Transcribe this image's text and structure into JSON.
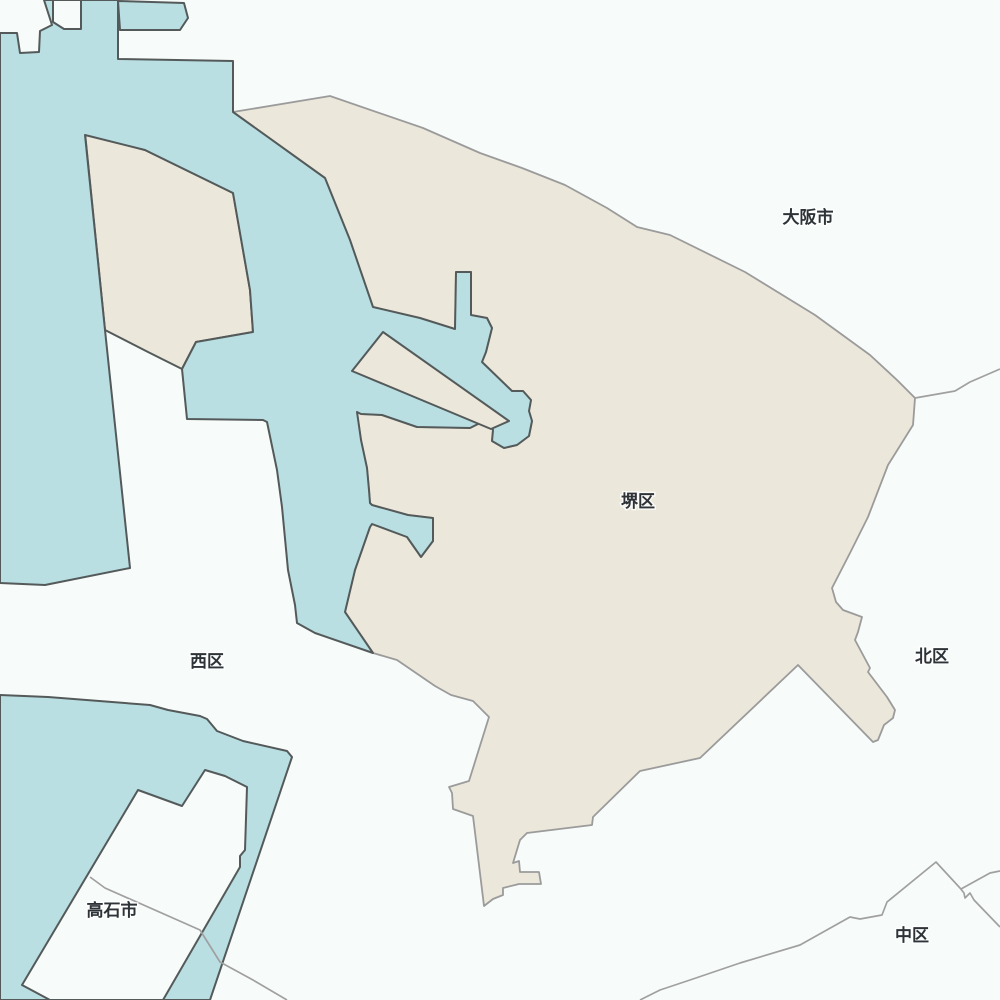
{
  "map": {
    "description": "Administrative map of Sakai ward area with harbor waterways",
    "highlighted_region": "堺区",
    "colors": {
      "land": "#f7fbf9",
      "highlight": "#ebe7da",
      "water": "#b9dfe3",
      "water_border": "#545a5a",
      "land_border": "#9b9b9b",
      "boundary_line": "#a0a0a0",
      "label": "#2e3338"
    },
    "region_labels": [
      {
        "id": "osaka-shi",
        "text": "大阪市",
        "x": 808,
        "y": 223
      },
      {
        "id": "sakai-ku",
        "text": "堺区",
        "x": 638,
        "y": 507
      },
      {
        "id": "nishi-ku",
        "text": "西区",
        "x": 207,
        "y": 667
      },
      {
        "id": "kita-ku",
        "text": "北区",
        "x": 932,
        "y": 662
      },
      {
        "id": "takaishi-shi",
        "text": "高石市",
        "x": 112,
        "y": 916
      },
      {
        "id": "naka-ku",
        "text": "中区",
        "x": 912,
        "y": 941
      }
    ],
    "shapes": [
      {
        "name": "region-sakai-ku-polygon",
        "fill_role": "highlight",
        "stroke_role": "land_border",
        "stroke_width": 1.8,
        "points": "233,112 330,96 423,128 480,153 522,168 565,185 607,208 637,227 670,235 745,272 815,315 870,355 897,380 915,398 913,425 888,465 868,517 850,553 832,588 836,602 843,610 862,617 858,632 855,640 870,668 868,672 887,697 895,710 893,718 884,725 878,740 873,742 798,665 700,758 640,771 593,817 592,825 527,833 520,840 513,863 519,861 520,872 539,872 541,884 519,884 503,888 503,895 493,899 484,906 473,816 453,809 452,793 449,787 469,781 489,717 473,701 451,695 435,686 397,660 373,653 345,612 355,570 370,527 372,524 407,537 421,557 433,541 433,518 408,515 372,505 370,503 369,490 367,468 361,440 357,412 361,414 382,415 417,427 470,428 488,419 493,430 492,441 504,448 517,445 529,436 532,421 529,411 531,400 523,391 512,391 482,362 486,352 492,328 487,318 471,315 471,272 456,272 455,329 420,318 373,307 350,240 325,178"
      },
      {
        "name": "region-sakai-wedge-polygon",
        "fill_role": "highlight",
        "stroke_role": "water_border",
        "stroke_width": 2,
        "points": "85,133 145,150 233,193 250,290 253,332 196,342 182,369 148,352 105,330"
      },
      {
        "name": "water-harbor-main",
        "fill_role": "water",
        "stroke_role": "water_border",
        "stroke_width": 2,
        "points": "44,0 52,25 40,31 39,52 20,53 17,33 0,33 0,583 45,585 130,568 105,330 85,135 145,150 233,193 250,290 253,332 196,342 182,369 187,419 263,420 267,422 277,470 282,507 288,570 295,605 297,623 315,633 373,653 345,612 355,570 370,527 372,524 407,537 421,557 433,541 433,518 408,515 372,505 370,503 369,490 367,468 361,440 357,412 361,414 382,415 417,427 470,428 488,419 493,430 492,441 504,448 517,445 529,436 532,421 529,411 531,400 523,391 512,391 482,362 486,352 492,328 487,318 471,315 471,272 456,272 455,329 420,318 373,307 350,240 325,178 233,112 233,61 118,59 118,0"
      },
      {
        "name": "water-basin-rect",
        "fill_role": "water",
        "stroke_role": "water_border",
        "stroke_width": 2,
        "points": "118,1 184,3 188,18 180,30 120,30"
      },
      {
        "name": "water-southwest-landfill",
        "fill_role": "water",
        "stroke_role": "water_border",
        "stroke_width": 2,
        "points": "0,695 48,697 150,705 168,710 200,716 207,719 217,731 243,741 287,751 292,757 210,1000 0,1000"
      },
      {
        "name": "breakwater-wharf",
        "fill_role": "highlight",
        "stroke_role": "water_border",
        "stroke_width": 2,
        "points": "383,332 509,421 491,429 352,371"
      },
      {
        "name": "takaishi-inner-land",
        "fill_role": "land",
        "stroke_role": "water_border",
        "stroke_width": 2,
        "points": "138,790 182,806 205,770 225,776 247,787 245,850 240,856 240,867 163,1000 50,1000 22,985"
      },
      {
        "name": "north-inner-land-pocket",
        "fill_role": "land",
        "stroke_role": "water_border",
        "stroke_width": 2,
        "points": "53,0 81,0 81,29 64,29 53,22"
      }
    ],
    "boundary_lines": [
      {
        "name": "boundary-osaka-kita",
        "points": "915,398 955,391 970,382 1000,369"
      },
      {
        "name": "boundary-naka-south",
        "points": "640,1000 660,990 690,980 740,963 800,945 850,917 860,919 882,915 887,902 936,862 960,888 964,893 965,898 970,893 974,900 1000,927"
      },
      {
        "name": "boundary-kita-naka",
        "points": "961,889 990,873 1000,871"
      },
      {
        "name": "boundary-takaishi",
        "points": "90,877 105,888 200,930 220,962 253,980 287,1000"
      }
    ]
  }
}
